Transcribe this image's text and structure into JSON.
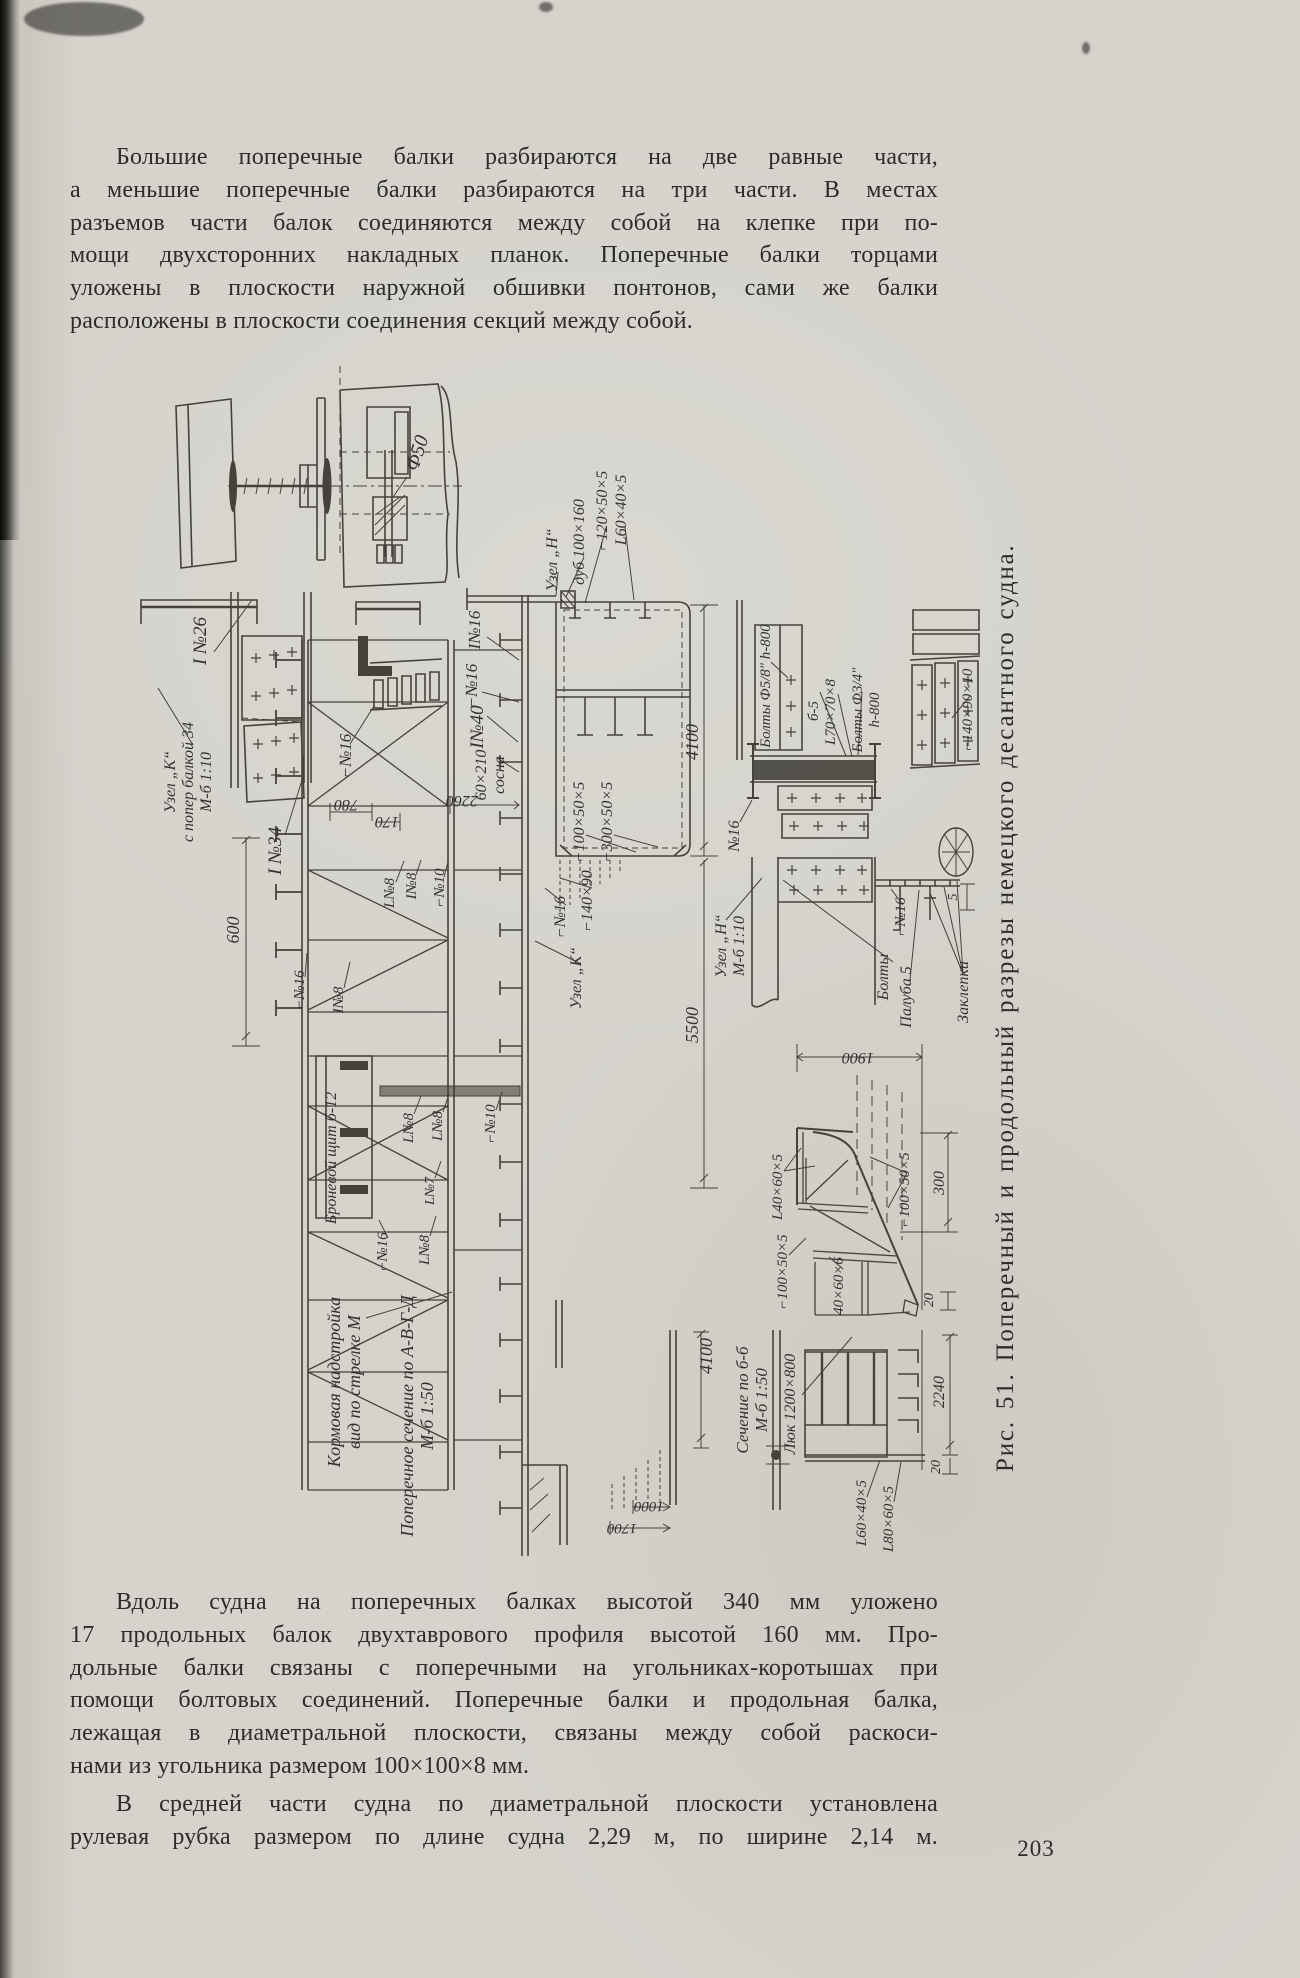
{
  "page": {
    "number": "203"
  },
  "colors": {
    "paper": "#d5d3cc",
    "ink": "#2e2c27",
    "line": "#45423b"
  },
  "paragraphs": [
    {
      "indent": true,
      "justify_last": false,
      "top": 141,
      "lines": [
        "Большие поперечные балки разбираются на две равные части,",
        "а меньшие поперечные балки разбираются на три части. В местах",
        "разъемов части балок соединяются между собой на клепке при по-",
        "мощи двухсторонних накладных планок. Поперечные балки торцами",
        "уложены в плоскости наружной обшивки понтонов, сами же балки",
        "расположены в плоскости соединения секций между собой."
      ]
    },
    {
      "indent": true,
      "justify_last": false,
      "top": 1586,
      "lines": [
        "Вдоль судна на поперечных балках высотой 340 мм уложено",
        "17 продольных балок двухтаврового профиля высотой 160 мм. Про-",
        "дольные балки связаны с поперечными на угольниках-коротышах при",
        "помощи болтовых соединений. Поперечные балки и продольная балка,",
        "лежащая в диаметральной плоскости, связаны между собой раскоси-",
        "нами из угольника размером 100×100×8 мм."
      ]
    },
    {
      "indent": true,
      "justify_last": true,
      "top": 1788,
      "lines": [
        "В средней части судна по диаметральной плоскости установлена",
        "рулевая рубка размером по длине  судна  2,29 м, по ширине 2,14 м."
      ]
    }
  ],
  "figure": {
    "caption": "Рис. 51. Поперечный и продольный разрезы немецкого десантного судна.",
    "labels": [
      {
        "t": "Ф50",
        "x": 423,
        "y": 455,
        "r": -72,
        "s": 20
      },
      {
        "t": "I №26",
        "x": 206,
        "y": 641,
        "r": -90,
        "s": 19
      },
      {
        "t": "Узел „К“\nс попер балкой 34\nМ-б 1:10",
        "x": 175,
        "y": 782,
        "r": -90,
        "s": 16
      },
      {
        "t": "I №34",
        "x": 281,
        "y": 851,
        "r": -90,
        "s": 19
      },
      {
        "t": "⌐№16",
        "x": 351,
        "y": 756,
        "r": -90,
        "s": 17
      },
      {
        "t": "780",
        "x": 346,
        "y": 800,
        "r": 180,
        "s": 16
      },
      {
        "t": "170",
        "x": 387,
        "y": 817,
        "r": 180,
        "s": 16
      },
      {
        "t": "2260",
        "x": 462,
        "y": 796,
        "r": 180,
        "s": 16
      },
      {
        "t": "I№16",
        "x": 480,
        "y": 630,
        "r": -90,
        "s": 17
      },
      {
        "t": "⌐№16",
        "x": 477,
        "y": 686,
        "r": -90,
        "s": 17
      },
      {
        "t": "Узел „Н“",
        "x": 557,
        "y": 560,
        "r": -90,
        "s": 16
      },
      {
        "t": "дуб 100×160",
        "x": 584,
        "y": 542,
        "r": -90,
        "s": 16
      },
      {
        "t": "⌐120×50×5",
        "x": 607,
        "y": 511,
        "r": -90,
        "s": 16
      },
      {
        "t": "L60×40×5",
        "x": 626,
        "y": 510,
        "r": -90,
        "s": 16
      },
      {
        "t": "I№40",
        "x": 483,
        "y": 727,
        "r": -90,
        "s": 19
      },
      {
        "t": "60×210\nсосна",
        "x": 486,
        "y": 775,
        "r": -90,
        "s": 16
      },
      {
        "t": "⌐100×50×5",
        "x": 584,
        "y": 822,
        "r": -90,
        "s": 16
      },
      {
        "t": "⌐300×50×5",
        "x": 612,
        "y": 822,
        "r": -90,
        "s": 16
      },
      {
        "t": "4100",
        "x": 698,
        "y": 742,
        "r": -90,
        "s": 18
      },
      {
        "t": "⌐№16",
        "x": 565,
        "y": 917,
        "r": -90,
        "s": 16
      },
      {
        "t": "⌐140×90",
        "x": 592,
        "y": 901,
        "r": -90,
        "s": 16
      },
      {
        "t": "Узел „К“",
        "x": 581,
        "y": 978,
        "r": -90,
        "s": 16
      },
      {
        "t": "5500",
        "x": 698,
        "y": 1025,
        "r": -90,
        "s": 18
      },
      {
        "t": "Узел „Н“\nМ-б 1:10",
        "x": 726,
        "y": 946,
        "r": -90,
        "s": 16
      },
      {
        "t": "№16",
        "x": 739,
        "y": 836,
        "r": -90,
        "s": 16
      },
      {
        "t": "Болты Ф5/8″ h-800",
        "x": 770,
        "y": 686,
        "r": -90,
        "s": 15
      },
      {
        "t": "б-5",
        "x": 818,
        "y": 711,
        "r": -90,
        "s": 15
      },
      {
        "t": "L70×70×8",
        "x": 835,
        "y": 712,
        "r": -90,
        "s": 15
      },
      {
        "t": "Болты Ф3/4″\nh-800",
        "x": 862,
        "y": 710,
        "r": -90,
        "s": 15
      },
      {
        "t": "⌐140×90×10",
        "x": 972,
        "y": 710,
        "r": -90,
        "s": 15
      },
      {
        "t": "⌐№16",
        "x": 905,
        "y": 917,
        "r": -90,
        "s": 15
      },
      {
        "t": "Болты",
        "x": 888,
        "y": 977,
        "r": -90,
        "s": 16
      },
      {
        "t": "Палуба 5",
        "x": 911,
        "y": 997,
        "r": -90,
        "s": 16
      },
      {
        "t": "Заклепки",
        "x": 968,
        "y": 992,
        "r": -90,
        "s": 16
      },
      {
        "t": "5",
        "x": 957,
        "y": 897,
        "r": -90,
        "s": 14
      },
      {
        "t": "1900",
        "x": 858,
        "y": 1053,
        "r": 180,
        "s": 16
      },
      {
        "t": "L40×60×5",
        "x": 782,
        "y": 1187,
        "r": -90,
        "s": 15
      },
      {
        "t": "⌐100×50×5",
        "x": 909,
        "y": 1190,
        "r": -90,
        "s": 15
      },
      {
        "t": "300",
        "x": 944,
        "y": 1183,
        "r": -90,
        "s": 16
      },
      {
        "t": "⌐100×50×5",
        "x": 787,
        "y": 1272,
        "r": -90,
        "s": 15
      },
      {
        "t": "40×60×6",
        "x": 843,
        "y": 1286,
        "r": -90,
        "s": 15
      },
      {
        "t": "20",
        "x": 933,
        "y": 1300,
        "r": -90,
        "s": 14
      },
      {
        "t": "4100",
        "x": 712,
        "y": 1356,
        "r": -90,
        "s": 18
      },
      {
        "t": "Сечение по б-б\nМ-б 1:50",
        "x": 748,
        "y": 1400,
        "r": -90,
        "s": 17
      },
      {
        "t": "Люк 1200×800",
        "x": 795,
        "y": 1404,
        "r": -90,
        "s": 16
      },
      {
        "t": "2240",
        "x": 944,
        "y": 1392,
        "r": -90,
        "s": 16
      },
      {
        "t": "20",
        "x": 940,
        "y": 1467,
        "r": -90,
        "s": 14
      },
      {
        "t": "L60×40×5",
        "x": 866,
        "y": 1513,
        "r": -90,
        "s": 15
      },
      {
        "t": "L80×60×5",
        "x": 893,
        "y": 1519,
        "r": -90,
        "s": 15
      },
      {
        "t": "1000",
        "x": 649,
        "y": 1502,
        "r": 180,
        "s": 15
      },
      {
        "t": "1700",
        "x": 622,
        "y": 1524,
        "r": 180,
        "s": 15
      },
      {
        "t": "Кормовая надстройка\nвид по стрелке М",
        "x": 340,
        "y": 1382,
        "r": -90,
        "s": 18
      },
      {
        "t": "Поперечное сечение по А-В-Г-Д\nМ-б 1:50",
        "x": 413,
        "y": 1416,
        "r": -90,
        "s": 18
      },
      {
        "t": "600",
        "x": 239,
        "y": 930,
        "r": -90,
        "s": 18
      },
      {
        "t": "Броневой щит б-12",
        "x": 336,
        "y": 1158,
        "r": -90,
        "s": 16
      },
      {
        "t": "L№8",
        "x": 413,
        "y": 1128,
        "r": -90,
        "s": 15
      },
      {
        "t": "L№8",
        "x": 442,
        "y": 1126,
        "r": -90,
        "s": 15
      },
      {
        "t": "⌐№10",
        "x": 495,
        "y": 1124,
        "r": -90,
        "s": 15
      },
      {
        "t": "L№7",
        "x": 434,
        "y": 1191,
        "r": -90,
        "s": 14
      },
      {
        "t": "⌐№16",
        "x": 387,
        "y": 1252,
        "r": -90,
        "s": 15
      },
      {
        "t": "L№8",
        "x": 429,
        "y": 1250,
        "r": -90,
        "s": 15
      },
      {
        "t": "⌐№16",
        "x": 304,
        "y": 990,
        "r": -90,
        "s": 15
      },
      {
        "t": "I№8",
        "x": 343,
        "y": 1000,
        "r": -90,
        "s": 15
      },
      {
        "t": "L№8",
        "x": 394,
        "y": 893,
        "r": -90,
        "s": 15
      },
      {
        "t": "I№8",
        "x": 416,
        "y": 886,
        "r": -90,
        "s": 15
      },
      {
        "t": "⌐№10",
        "x": 444,
        "y": 888,
        "r": -90,
        "s": 15
      }
    ]
  }
}
